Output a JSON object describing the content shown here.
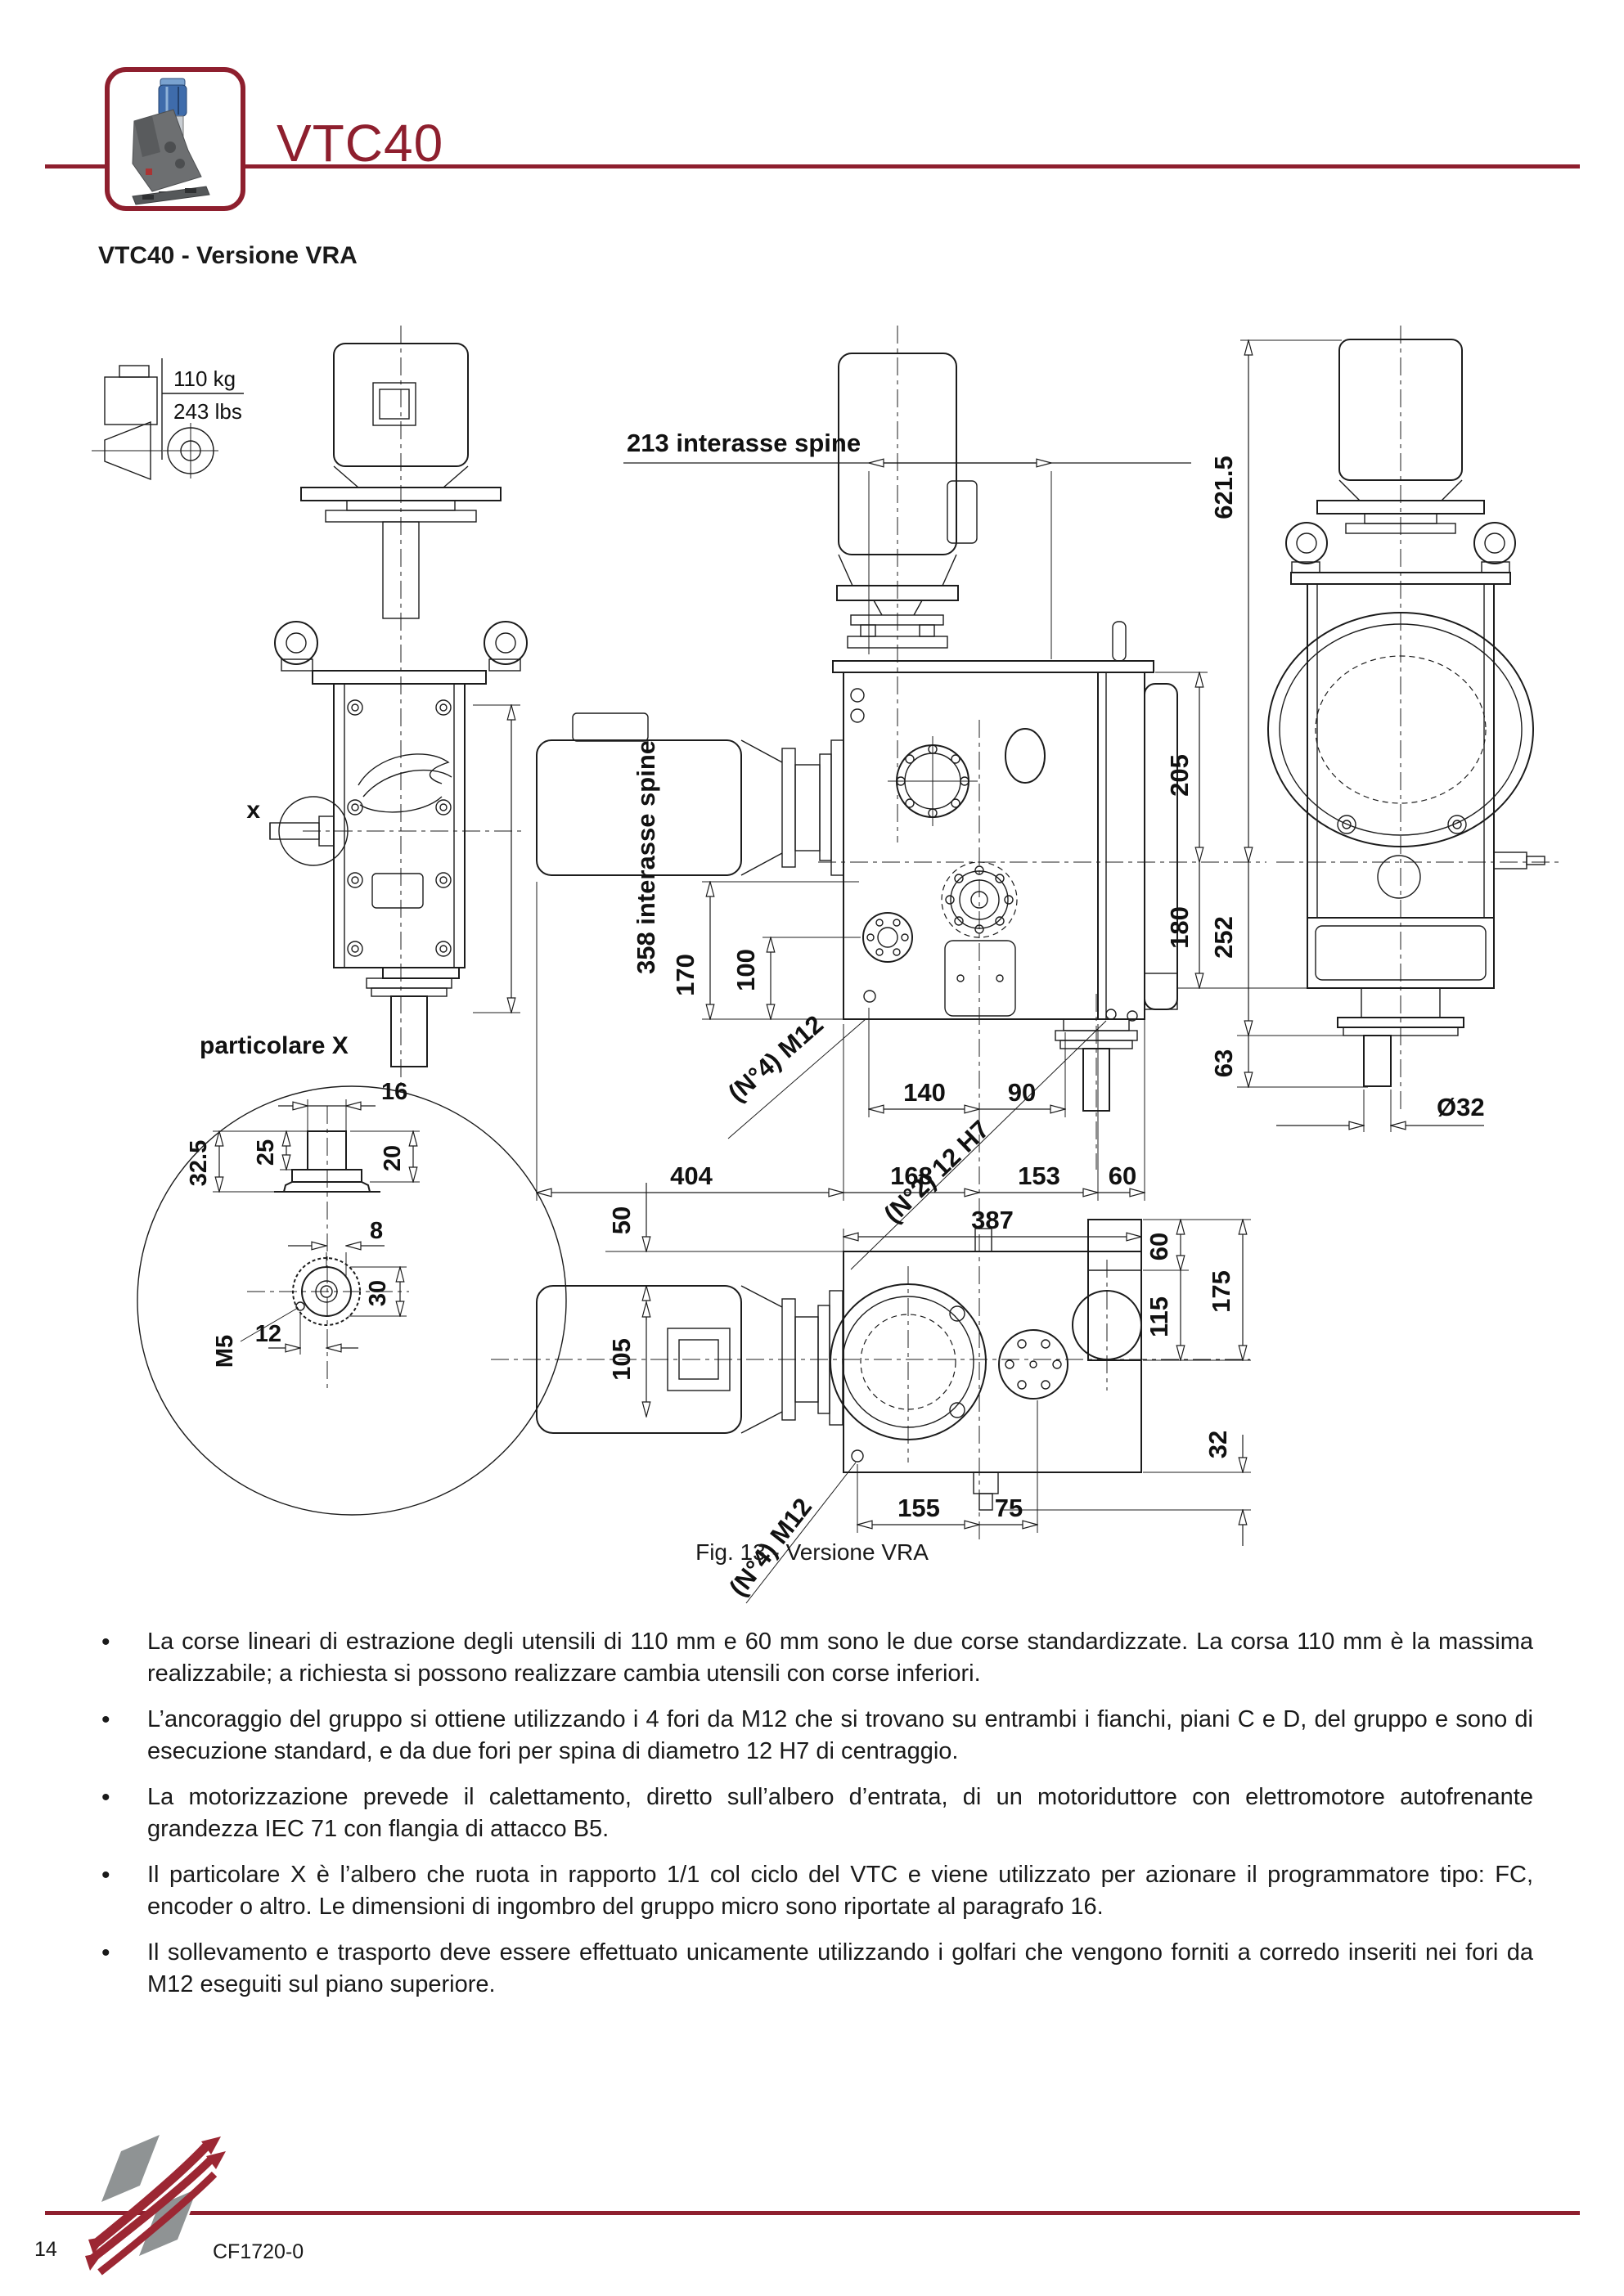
{
  "colors": {
    "accent": "#8e1f2e",
    "ink": "#1c1c1c",
    "paper": "#ffffff"
  },
  "header": {
    "title": "VTC40",
    "subtitle": "VTC40 - Versione VRA"
  },
  "figure": {
    "caption": "Fig. 13 - Versione VRA",
    "weight": {
      "kg": "110 kg",
      "lbs": "243 lbs"
    },
    "labels": {
      "top_span": "213  interasse spine",
      "side_span": "358  interasse spine",
      "d170": "170",
      "d100": "100",
      "d205": "205",
      "d180": "180",
      "d621": "621.5",
      "d252": "252",
      "d63": "63",
      "holes_m12_front": "(N°4) M12",
      "pins_12h7": "(N°2) 12 H7",
      "d140": "140",
      "d90": "90",
      "d404": "404",
      "d168": "168",
      "d153": "153",
      "d60a": "60",
      "d387": "387",
      "d50": "50",
      "d105": "105",
      "d60b": "60",
      "d115": "115",
      "d175": "175",
      "d32": "32",
      "d155": "155",
      "d75": "75",
      "holes_m12_plan": "(N°4) M12",
      "dia32": "Ø32",
      "x_label": "x",
      "detail_label": "particolare X",
      "d16": "16",
      "d32_5": "32.5",
      "d25": "25",
      "d20": "20",
      "d8": "8",
      "d30": "30",
      "d12": "12",
      "m5": "M5"
    }
  },
  "bullets": [
    "La corse lineari di estrazione degli utensili di 110 mm e 60 mm sono le due corse standardizzate. La corsa 110 mm è la massima realizzabile; a richiesta si possono realizzare cambia utensili con corse inferiori.",
    "L’ancoraggio del gruppo si ottiene utilizzando i 4 fori da M12 che si trovano su entrambi i fianchi, piani C e D, del gruppo e sono di esecuzione standard, e da due fori per spina di diametro 12 H7 di centraggio.",
    "La motorizzazione prevede il calettamento, diretto sull’albero d’entrata, di un motoriduttore con elettromotore autofrenante grandezza IEC 71 con flangia di attacco  B5.",
    "Il particolare X è l’albero che ruota in rapporto 1/1 col ciclo del VTC e viene utilizzato per azionare il programmatore tipo: FC, encoder o altro. Le dimensioni di ingombro del gruppo micro sono riportate al paragrafo  16.",
    "Il sollevamento e trasporto deve essere effettuato unicamente utilizzando i golfari che vengono forniti a corredo inseriti nei fori da M12 eseguiti sul piano superiore."
  ],
  "footer": {
    "page_number": "14",
    "doc_code": "CF1720-0"
  }
}
